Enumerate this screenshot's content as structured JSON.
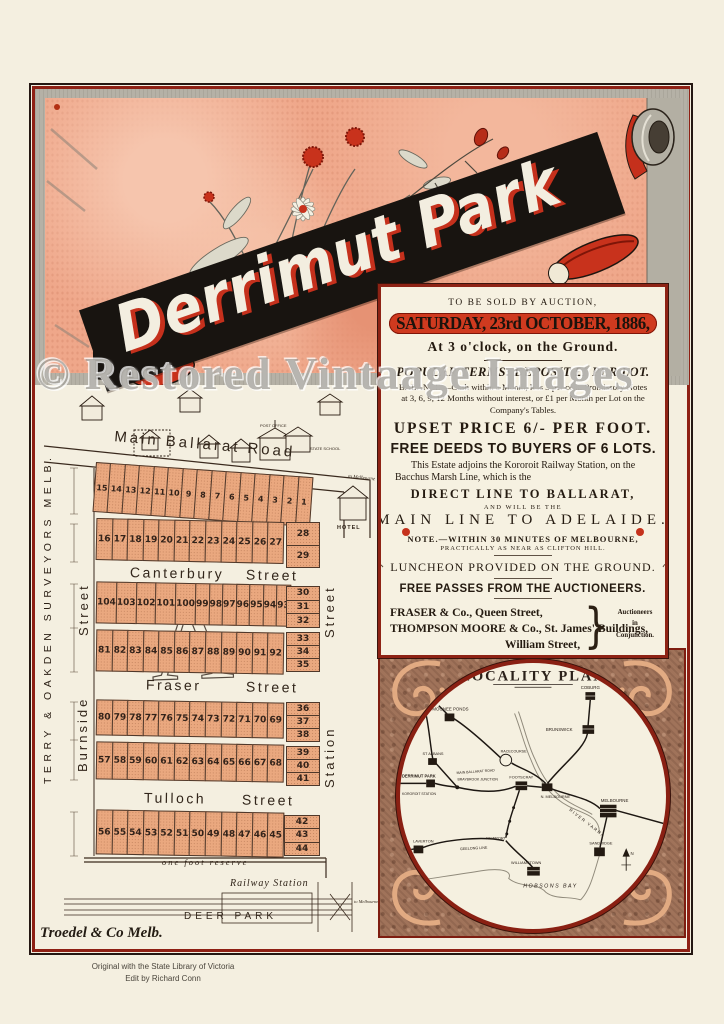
{
  "watermark": "© Restored Vintaage Images",
  "banner": {
    "title": "Derrimut Park"
  },
  "auction": {
    "preamble": "TO BE SOLD BY AUCTION,",
    "date_banner": "SATURDAY, 23rd OCTOBER, 1886,",
    "time_line": "At 3 o'clock, on the Ground.",
    "terms_heading": "POPULAR TERMS: DEPOSIT £1 PER LOT.",
    "terms_body": "BALANCE.—Cash within a Month, less 3 per cent. Promissory Notes at 3, 6, 9, 12 Months without interest, or £1 per Month per Lot on the Company's Tables.",
    "upset_price": "UPSET PRICE 6/- PER FOOT.",
    "free_deeds": "FREE DEEDS TO BUYERS OF 6 LOTS.",
    "estate_text": "This Estate adjoins the Kororoit Railway Station, on the Bacchus Marsh Line, which is the",
    "direct_line": "DIRECT LINE TO BALLARAT,",
    "and_will_be": "AND WILL BE THE",
    "main_line": "MAIN LINE TO ADELAIDE.",
    "note_line1": "NOTE.—WITHIN 30 MINUTES OF MELBOURNE,",
    "note_line2": "PRACTICALLY AS NEAR AS CLIFTON HILL.",
    "luncheon": "LUNCHEON PROVIDED ON THE GROUND.",
    "free_passes": "FREE PASSES FROM THE AUCTIONEERS.",
    "auctioneer1": "FRASER & Co., Queen Street,",
    "auctioneer2": "THOMPSON MOORE & Co., St. James' Buildings,",
    "auctioneer2b": "William Street,",
    "auctioneer3": "BLISS & PERYMAN, Collins Street West.",
    "conjunction1": "Auctioneers",
    "conjunction2": "in",
    "conjunction3": "Conjunction."
  },
  "map": {
    "surveyors": "TERRY & OAKDEN SURVEYORS MELB.",
    "main_road": "Main Ballarat Road",
    "canterbury_1": "Canterbury",
    "canterbury_2": "Street",
    "fraser_1": "Fraser",
    "fraser_2": "Street",
    "tulloch_1": "Tulloch",
    "tulloch_2": "Street",
    "burnside": "Burnside",
    "burnside_street": "Street",
    "station": "Station",
    "station_street": "Street",
    "hotel": "HOTEL",
    "post_office": "POST OFFICE",
    "state_school": "STATE SCHOOL",
    "to_melbourne_road": "to Melbourne",
    "one_foot_reserve": "one foot reserve",
    "railway_station": "Railway Station",
    "to_melbourne_rail": "to Melbourne",
    "deer_park": "DEER PARK",
    "printer": "Troedel & Co Melb.",
    "lots": {
      "rowA1": [
        15,
        14,
        13,
        12,
        11,
        10,
        9,
        8,
        7,
        6,
        5,
        4,
        3,
        2,
        1
      ],
      "rowA2": [
        16,
        17,
        18,
        19,
        20,
        21,
        22,
        23,
        24,
        25,
        26,
        27
      ],
      "colA": [
        28,
        29
      ],
      "rowB1": [
        104,
        103,
        102,
        101,
        100,
        99,
        98,
        97,
        96,
        95,
        94,
        93
      ],
      "rowB2": [
        81,
        82,
        83,
        84,
        85,
        86,
        87,
        88,
        89,
        90,
        91,
        92
      ],
      "colB1": [
        30,
        31,
        32
      ],
      "colB2": [
        33,
        34,
        35
      ],
      "rowC1": [
        80,
        79,
        78,
        77,
        76,
        75,
        74,
        73,
        72,
        71,
        70,
        69
      ],
      "rowC2": [
        57,
        58,
        59,
        60,
        61,
        62,
        63,
        64,
        65,
        66,
        67,
        68
      ],
      "colC1": [
        36,
        37,
        38
      ],
      "colC2": [
        39,
        40,
        41
      ],
      "rowD": [
        56,
        55,
        54,
        53,
        52,
        51,
        50,
        49,
        48,
        47,
        46,
        45
      ],
      "colD": [
        42,
        43,
        44
      ]
    }
  },
  "locality": {
    "title": "LOCALITY PLAN",
    "stations": [
      {
        "name": "COBURG"
      },
      {
        "name": "MOONEE PONDS"
      },
      {
        "name": "BRUNSWICK"
      },
      {
        "name": "RACECOURSE"
      },
      {
        "name": "ST ALBANS"
      },
      {
        "name": "MAIN BALLARAT ROAD"
      },
      {
        "name": "DERRIMUT PARK"
      },
      {
        "name": "KOROROIT STATION"
      },
      {
        "name": "BRAYBROOK JUNCTION"
      },
      {
        "name": "FOOTSCRAY"
      },
      {
        "name": "N. MELBOURNE"
      },
      {
        "name": "MELBOURNE"
      },
      {
        "name": "RIVER YARRA"
      },
      {
        "name": "NEWPORT"
      },
      {
        "name": "LAVERTON"
      },
      {
        "name": "GEELONG LINE"
      },
      {
        "name": "WILLIAMSTOWN"
      },
      {
        "name": "HOBSONS BAY"
      },
      {
        "name": "SANDRIDGE"
      },
      {
        "name": "N"
      }
    ]
  },
  "credits": {
    "line1": "Original with the State Library of Victoria",
    "line2": "Edit by Richard Conn"
  },
  "colors": {
    "accent_red": "#c5321c",
    "panel_border": "#8e2315",
    "banner_pink": "#efa78a",
    "lot_fill": "#eaa87f",
    "frame_red": "#8e2014",
    "ornate_brown": "#a0735a"
  }
}
